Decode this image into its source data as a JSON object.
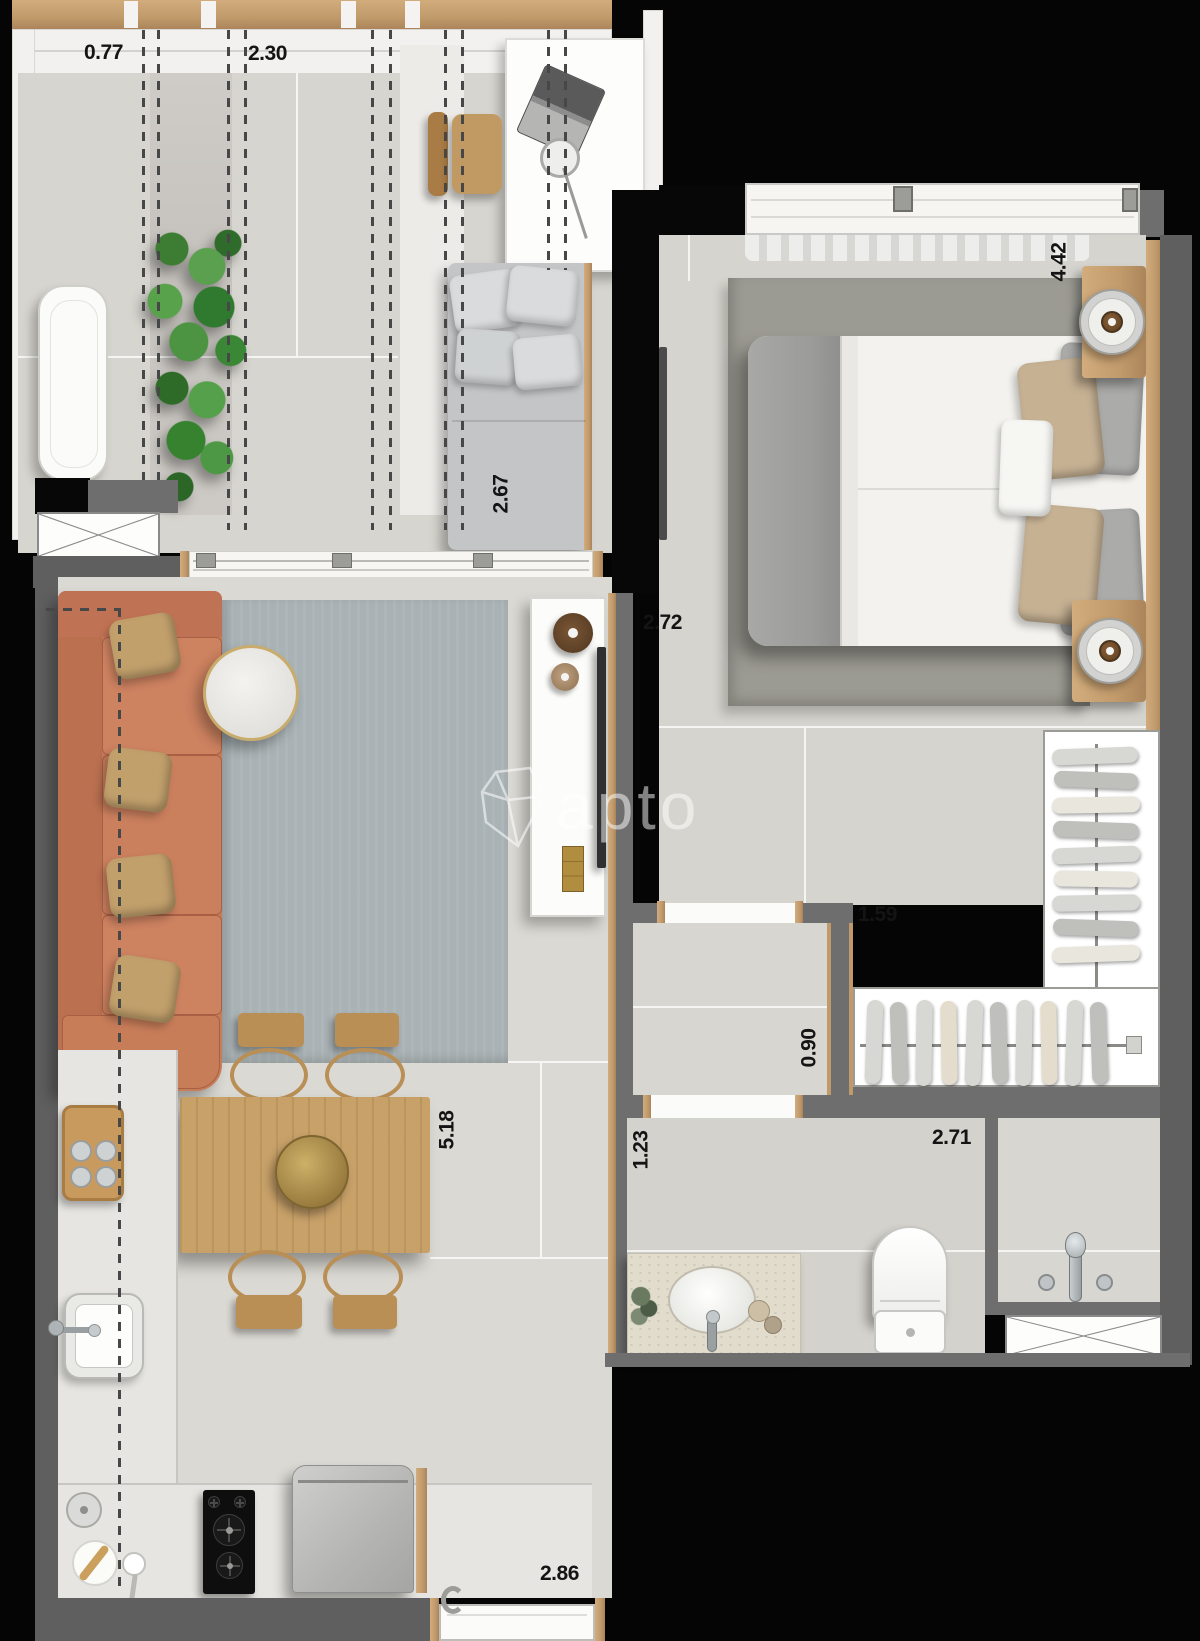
{
  "watermark": {
    "brand": "apto"
  },
  "dimension_labels": {
    "balcony_segment_a": "0.77",
    "balcony_segment_b": "2.30",
    "balcony_depth": "2.67",
    "bedroom_depth": "4.42",
    "bedroom_entry_width": "2.72",
    "closet_width": "1.59",
    "closet_aisle_width": "0.90",
    "living_depth": "5.18",
    "bathroom_entry_width": "1.23",
    "bathroom_width": "2.71",
    "kitchen_width": "2.86"
  },
  "colors": {
    "background": "#050505",
    "wall_gray": "#6e6e6e",
    "wood_trim": "#c19a6b",
    "floor_tile": "#d8d6d0",
    "sofa_terracotta": "#c87d59",
    "living_rug": "#a9b2b5",
    "bedroom_rug": "#9c9b93",
    "plant_green": "#4e8f3e",
    "dining_wood": "#c8a169"
  }
}
